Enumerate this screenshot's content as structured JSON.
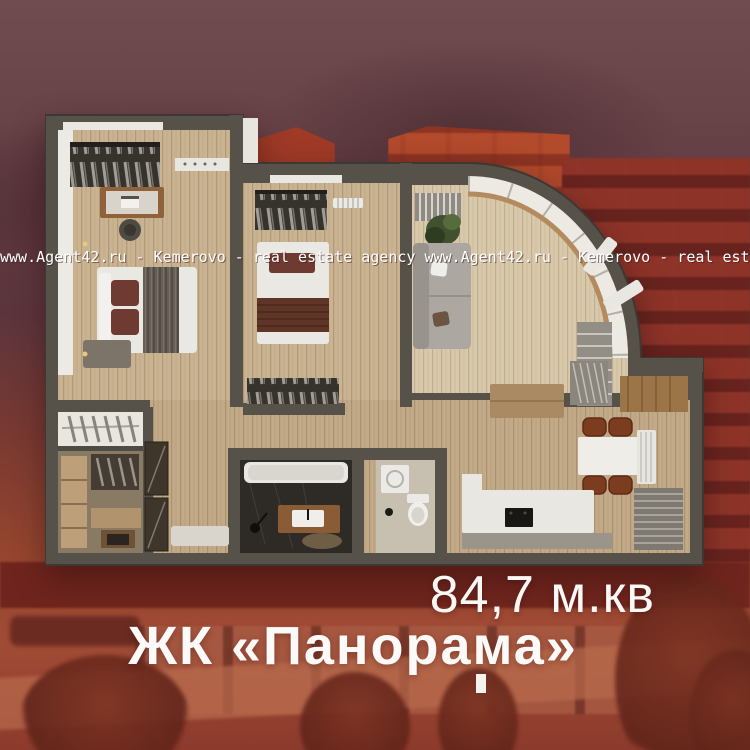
{
  "watermark": {
    "text": "www.Agent42.ru - Kemerovo - real estate agency",
    "line": "www.Agent42.ru - Kemerovo - real estate agency  www.Agent42.ru - Kemerovo - real estate agency  www.Agent42.ru - Kemerovo - real estate agency"
  },
  "listing": {
    "area_label": "84,7 м.кв",
    "project_name": "ЖК «Панорама»"
  },
  "floorplan": {
    "rooms": [
      "master-bedroom",
      "second-bedroom",
      "living-room",
      "kitchen-dining",
      "hallway",
      "bathroom",
      "wc",
      "walk-in-closet"
    ]
  },
  "colors": {
    "background_red": "#9c4733",
    "sky_maroon": "#6f4b4f",
    "bright_building": "#ad4229",
    "wall_gray": "#56524a",
    "floor_wood": "#c9b392",
    "text_white": "#fbfaf8"
  }
}
